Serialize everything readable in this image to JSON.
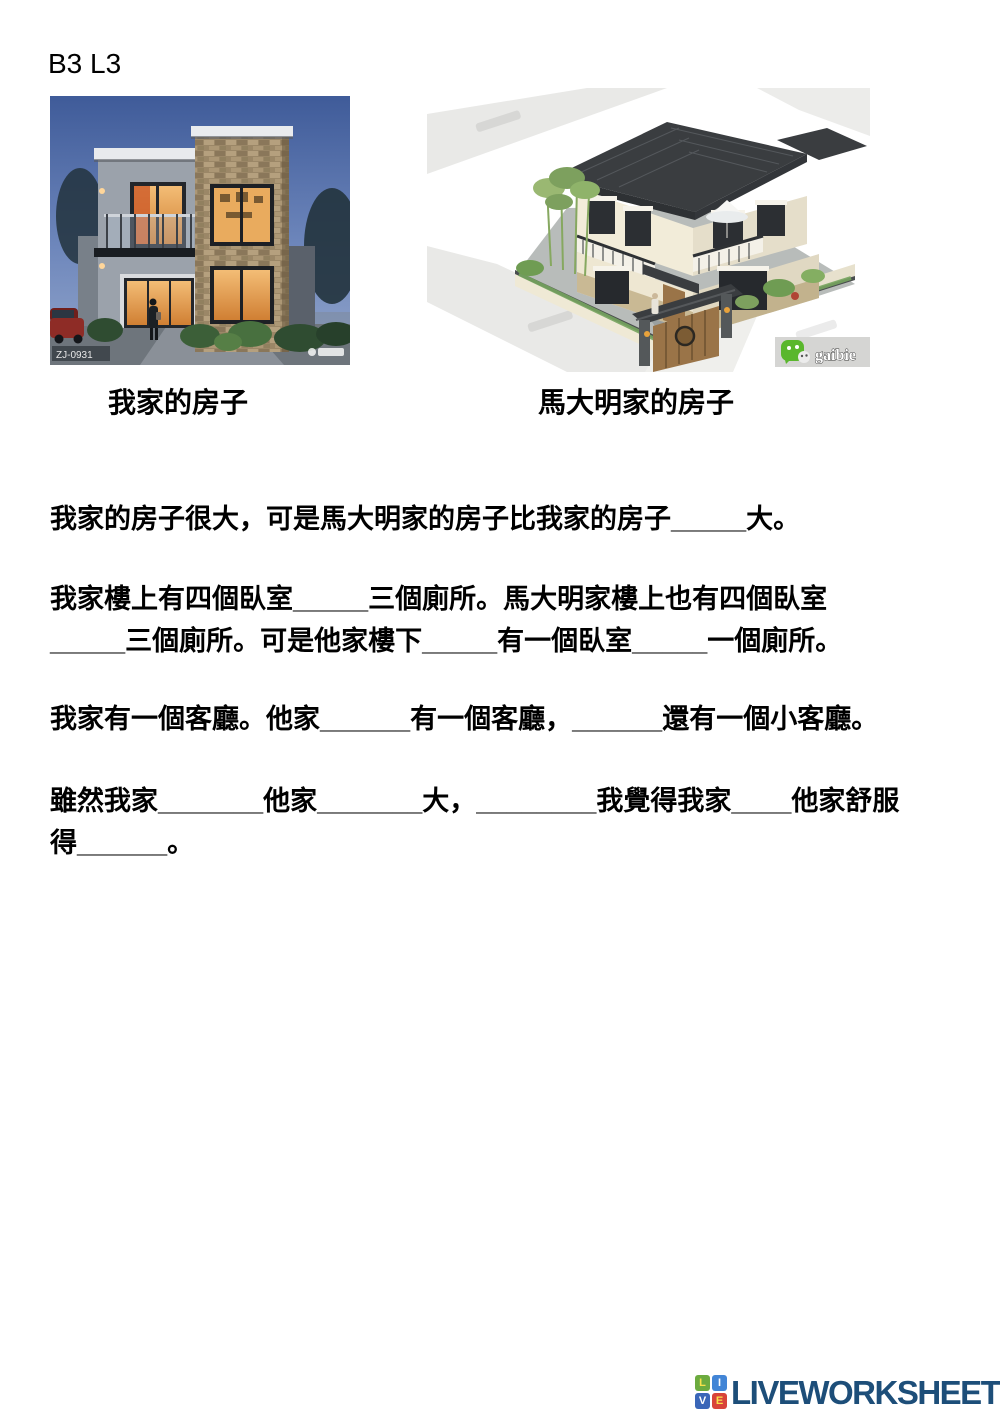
{
  "page": {
    "lesson_label": "B3 L3"
  },
  "figures": {
    "left": {
      "caption": "我家的房子",
      "watermark": "ZJ-0931"
    },
    "right": {
      "caption": "馬大明家的房子",
      "brand_text": "gaibie",
      "brand_icon": "wechat-icon"
    }
  },
  "passage": {
    "lines": [
      "我家的房子很大，可是馬大明家的房子比我家的房子_____大。",
      "我家樓上有四個臥室_____三個廁所。馬大明家樓上也有四個臥室",
      "_____三個廁所。可是他家樓下_____有一個臥室_____一個廁所。",
      "我家有一個客廳。他家______有一個客廳，______還有一個小客廳。",
      "雖然我家_______他家_______大，________我覺得我家____他家舒服",
      "得______。"
    ]
  },
  "footer": {
    "brand": "LIVEWORKSHEETS",
    "brand_color": "#1d4e79",
    "logo_letters": [
      "L",
      "I",
      "V",
      "E"
    ],
    "logo_colors": {
      "L": "#6cab3f",
      "I": "#4285d6",
      "V": "#3a66b8",
      "E": "#d8443a"
    }
  }
}
